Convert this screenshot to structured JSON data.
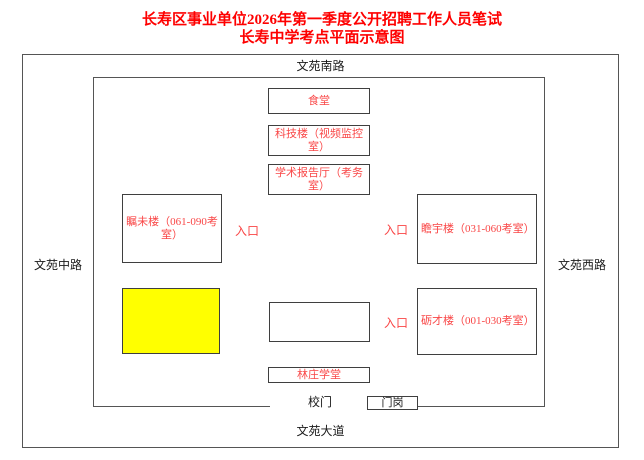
{
  "title": {
    "line1": "长寿区事业单位2026年第一季度公开招聘工作人员笔试",
    "line2": "长寿中学考点平面示意图"
  },
  "roads": {
    "north": "文苑南路",
    "west": "文苑中路",
    "east": "文苑西路",
    "south": "文苑大道"
  },
  "campus": {
    "buildings": {
      "canteen": {
        "label": "食堂"
      },
      "tech_building": {
        "label": "科技楼（视频监控室）"
      },
      "lecture_hall": {
        "label": "学术报告厅（考务室）"
      },
      "zhuwei_building": {
        "label": "瞩未楼（061-090考室）"
      },
      "zhanyu_building": {
        "label": "瞻宇楼（031-060考室）"
      },
      "licai_building": {
        "label": "砺才楼（001-030考室）"
      },
      "linzhuang_hall": {
        "label": "林庄学堂"
      }
    },
    "entrance_label": "入口",
    "gate_label": "校门",
    "guard_post_label": "门岗"
  },
  "colors": {
    "title_red": "#fe0000",
    "building_text_red": "#f94646",
    "highlight_yellow": "#ffff00",
    "line_gray": "#555555",
    "text_black": "#1a1a1a"
  }
}
